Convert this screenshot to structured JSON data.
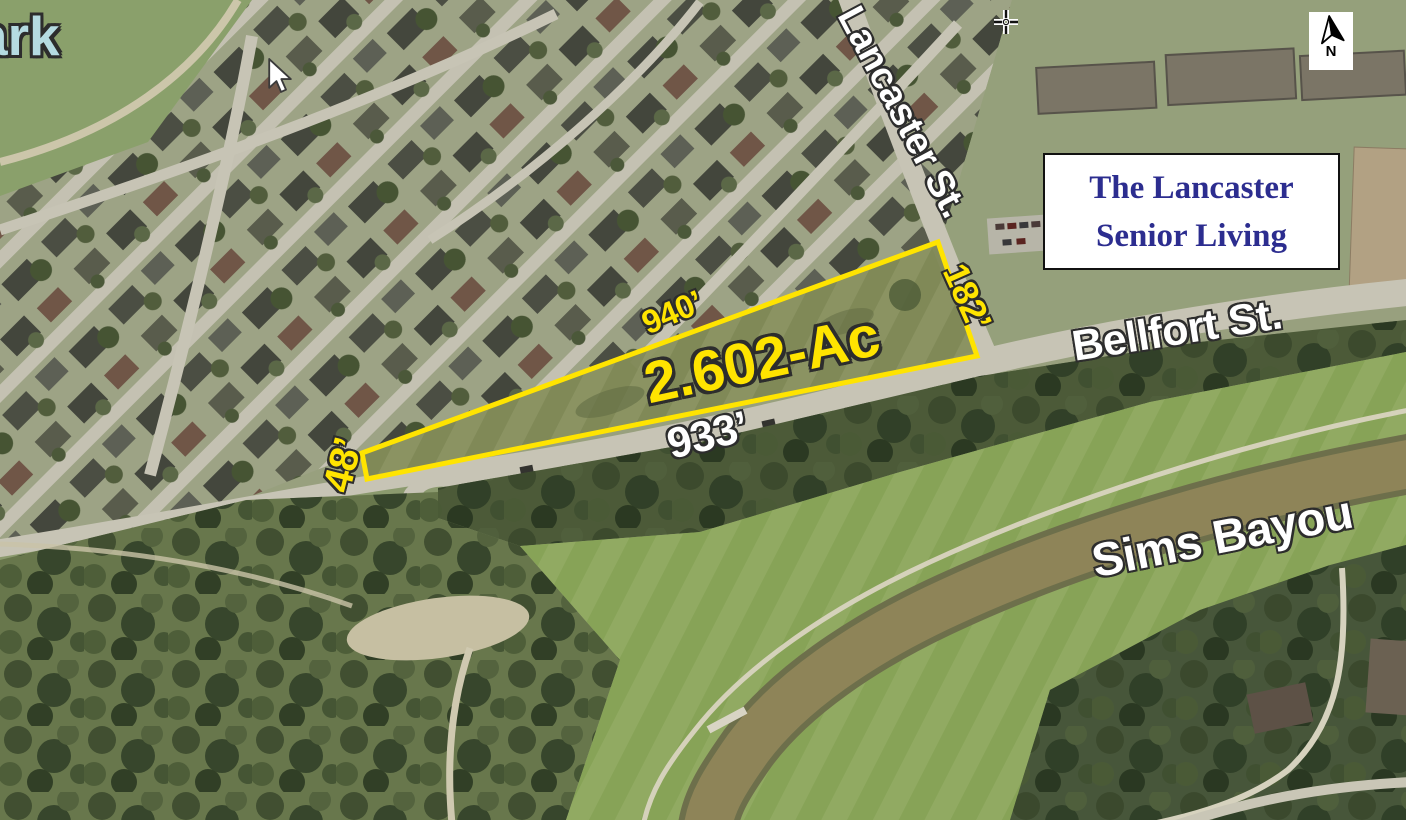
{
  "map": {
    "type": "aerial-site-map",
    "parcel": {
      "area_label": "2.602-Ac",
      "dim_north": "940’",
      "dim_south": "933’",
      "dim_east": "182’",
      "dim_west": "48’"
    },
    "streets": {
      "lancaster": "Lancaster St.",
      "bellfort": "Bellfort St."
    },
    "waterway": "Sims Bayou",
    "park": {
      "line1": "Robert C Stuart",
      "line2": "Park"
    },
    "callout": {
      "line1": "The Lancaster",
      "line2": "Senior Living"
    },
    "compass": {
      "label": "N"
    }
  },
  "icons": {
    "compass": "north-arrow",
    "cursor_pointer": "arrow-pointer",
    "cursor_crosshair": "crosshair"
  },
  "colors": {
    "parcel_outline": "#ffe400",
    "dim_yellow": "#ffe400",
    "label_white": "#ffffff",
    "label_outline": "#2d2d2d",
    "park_label": "#b5dbe1",
    "callout_text": "#2c2d8f"
  }
}
